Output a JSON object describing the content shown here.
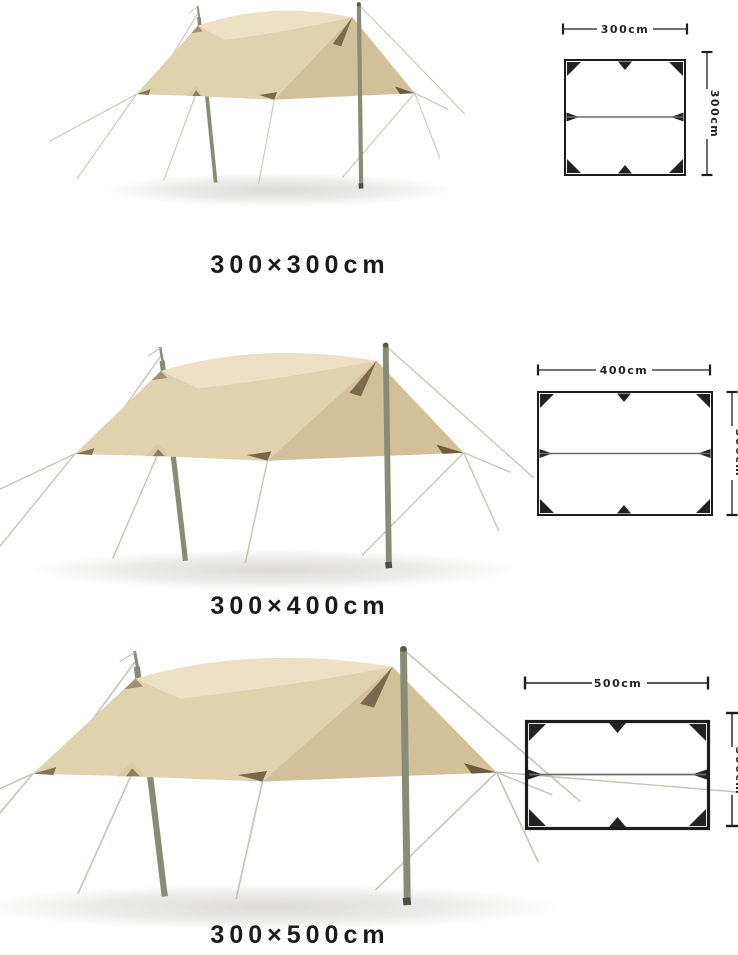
{
  "page": {
    "background": "#ffffff"
  },
  "colors": {
    "tarp_top": "#ece0c5",
    "tarp_front": "#e1d2af",
    "tarp_side": "#d2c09b",
    "trim_brown": "#6e5b40",
    "pole": "#878c77",
    "guy_line": "#c9c4b6",
    "diagram_line": "#1d1d1d",
    "label_text": "#1a1a1a"
  },
  "products": [
    {
      "label": "300×300cm",
      "diagram": {
        "width_label": "300cm",
        "height_label": "300cm"
      }
    },
    {
      "label": "300×400cm",
      "diagram": {
        "width_label": "400cm",
        "height_label": "300cm"
      }
    },
    {
      "label": "300×500cm",
      "diagram": {
        "width_label": "500cm",
        "height_label": "300cm"
      }
    }
  ]
}
